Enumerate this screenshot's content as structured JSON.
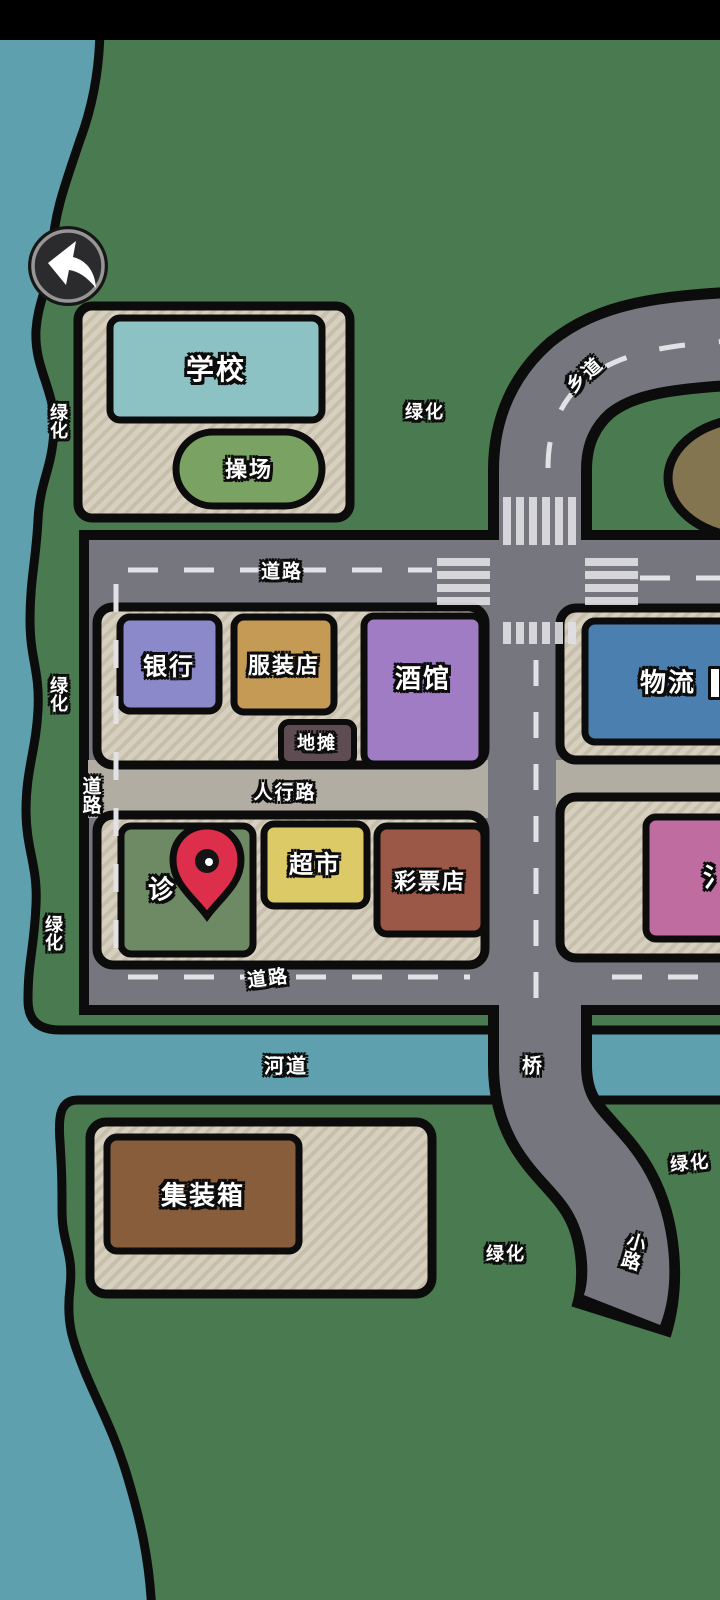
{
  "labels": {
    "school": "学校",
    "playground": "操场",
    "bank": "银行",
    "clothing_store": "服装店",
    "tavern": "酒馆",
    "street_stall": "地摊",
    "clinic_partial": "诊",
    "supermarket": "超市",
    "lottery_store": "彩票店",
    "logistics": "物流",
    "bath_partial": "氵",
    "container": "集装箱",
    "road_top": "道路",
    "road_bottom": "道路",
    "road_left": "道路",
    "pedestrian_road": "人行路",
    "river": "河道",
    "bridge": "桥",
    "small_road": "小路",
    "township_road": "乡道",
    "greenery": [
      "绿化",
      "绿化",
      "绿化",
      "绿化",
      "绿化",
      "绿化"
    ]
  },
  "icons": {
    "back": "back-arrow-icon",
    "pin": "location-pin-icon"
  },
  "colors": {
    "grass": "#4a7a4f",
    "water": "#5fa0ae",
    "road": "#76767e",
    "sidewalk": "#b2ada3",
    "plot": "#d7d0c1",
    "outline": "#0c0c0c",
    "pin_red": "#dd2e4c",
    "school": "#8cc2c3",
    "playground": "#7aa263",
    "bank": "#8b89ca",
    "clothing": "#c59a54",
    "tavern": "#a07cc5",
    "stall": "#5e4c52",
    "clinic": "#6d8a64",
    "supermarket": "#dcca67",
    "lottery": "#9c5847",
    "logistics": "#4a7fb0",
    "bath": "#bf6da0",
    "container": "#875d3c",
    "dirt": "#837550"
  }
}
